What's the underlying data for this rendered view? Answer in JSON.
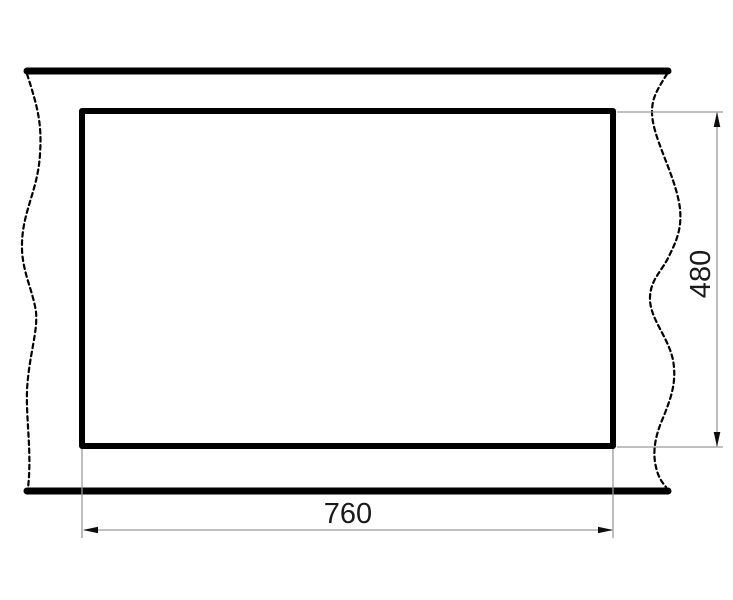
{
  "drawing": {
    "width_label": "760",
    "height_label": "480",
    "colors": {
      "outline": "#000000",
      "dimension_line": "#9a9a9a",
      "arrow": "#0d0d0d",
      "text": "#1a1a1a",
      "background": "#ffffff"
    }
  }
}
